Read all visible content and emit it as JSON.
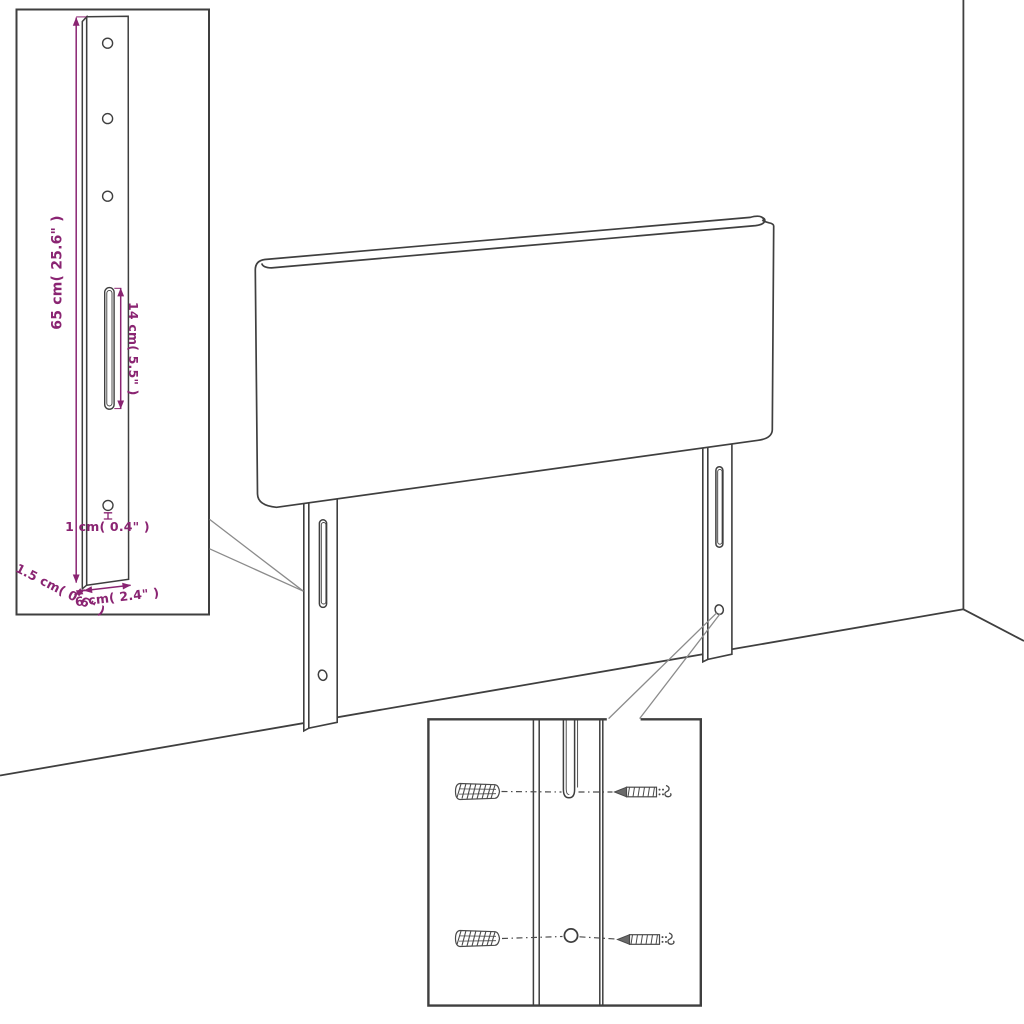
{
  "diagram": {
    "kind": "headboard-assembly-dimension-diagram",
    "leg_detail_inset": {
      "height_label": "65 cm( 25.6\" )",
      "slot_label": "14 cm( 5.5\" )",
      "hole_label": "1 cm( 0.4\" )",
      "thickness_label": "1.5 cm( 0.6\" )",
      "width_label": "6 cm( 2.4\" )"
    },
    "mounting_inset": {
      "parts": [
        "wall-plug",
        "screw",
        "leg-slot",
        "leg-hole"
      ]
    }
  },
  "colors": {
    "line": "#3f3f3f",
    "soft_line": "#8b8b8b",
    "accent": "#8a2472",
    "hardware": "#4a4a4a"
  }
}
